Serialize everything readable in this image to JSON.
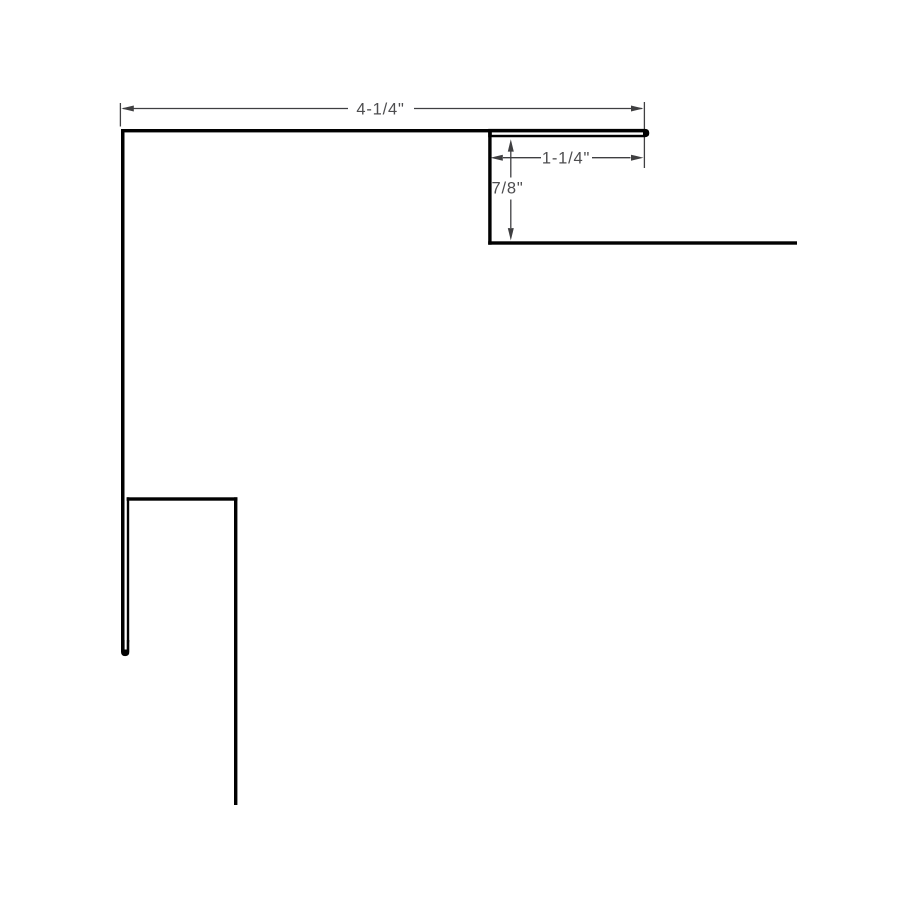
{
  "drawing": {
    "dimensions": {
      "top_width": "4-1/4\"",
      "hem_width": "1-1/4\"",
      "drop_height": "7/8\""
    },
    "colors": {
      "background": "#ffffff",
      "profile_line": "#010101",
      "dimension_line": "#3f3f41",
      "dimension_text": "#4d4d4f"
    }
  }
}
